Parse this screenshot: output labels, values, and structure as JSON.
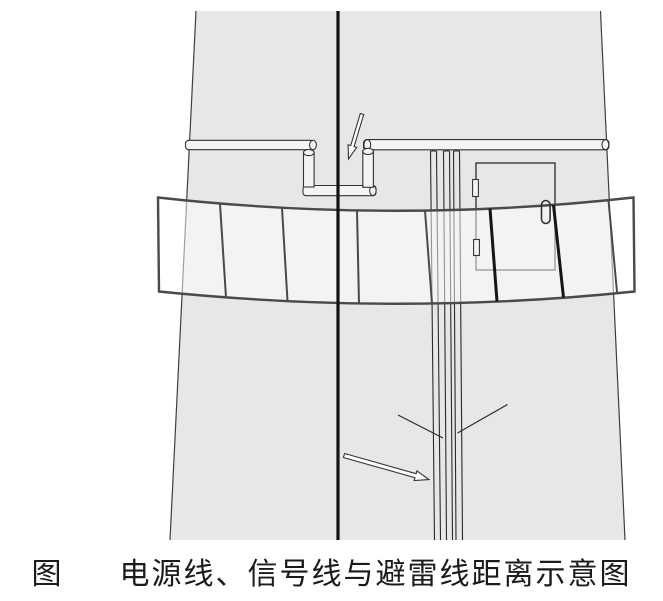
{
  "figure": {
    "label": "图",
    "caption": "电源线、信号线与避雷线距离示意图"
  },
  "colors": {
    "background": "#ffffff",
    "tower_fill": "#e7e7e7",
    "edge_stroke": "#3f3f3f",
    "line_black": "#121212",
    "thin_stroke": "#2a2a2a",
    "metal_fill": "#f4f4f4",
    "metal_stroke": "#333333",
    "band_fill": "rgba(255,255,255,0.5)",
    "band_stroke": "#4a4a4a",
    "divider_dark": "#151515",
    "arrow_fill": "#ffffff"
  }
}
